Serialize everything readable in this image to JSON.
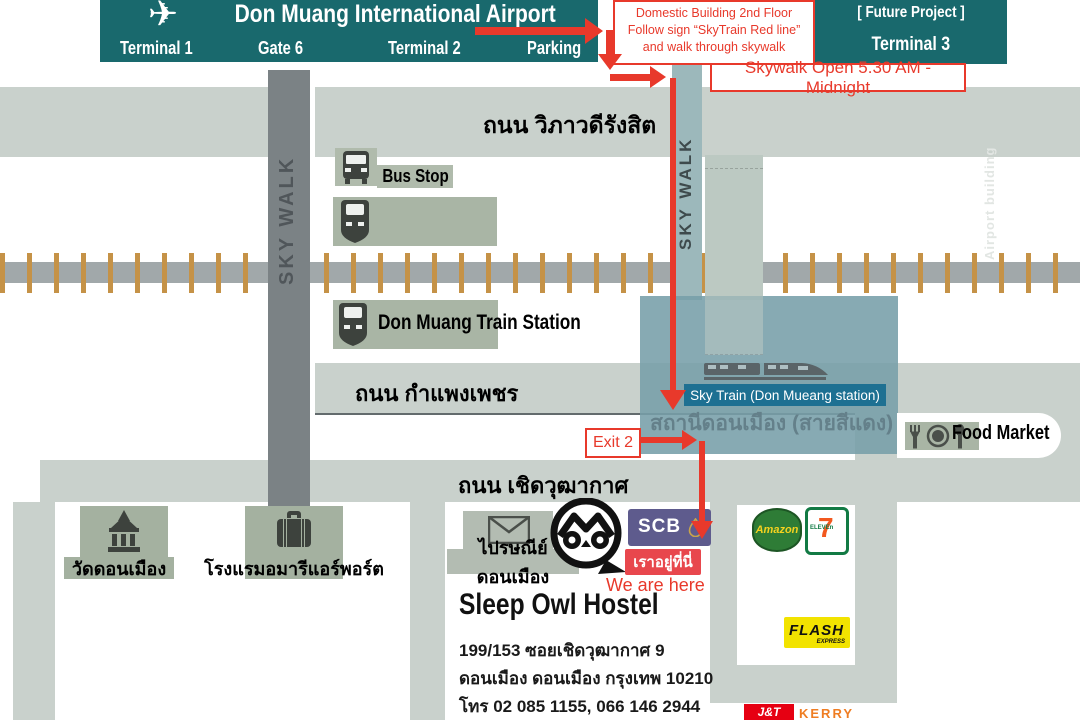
{
  "header": {
    "title": "Don Muang International Airport",
    "terminal1": "Terminal 1",
    "gate6": "Gate 6",
    "terminal2": "Terminal 2",
    "parking": "Parking"
  },
  "future_project": {
    "line1": "[ Future Project ]",
    "line2": "Terminal 3"
  },
  "notes": {
    "domestic1": "Domestic Building 2nd Floor",
    "domestic2": "Follow sign “SkyTrain Red line”",
    "domestic3": "and walk through skywalk",
    "skywalk_hours": "Skywalk Open 5.30 AM - Midnight",
    "exit": "Exit 2",
    "here_th": "เราอยู่ที่นี่",
    "here_en": "We are here"
  },
  "roads": {
    "vibhavadi_rangsit": "ถนน วิภาวดีรังสิต",
    "kamphaeng_phet": "ถนน กำแพงเพชร",
    "choet_wutthakat": "ถนน เชิดวุฒากาศ"
  },
  "skywalk": {
    "label": "SKY WALK"
  },
  "stations": {
    "bus_stop": "Bus Stop",
    "train_station": "Don Muang Train Station",
    "sky_train_en": "Sky Train (Don Mueang station)",
    "sky_train_th": "สถานีดอนเมือง (สายสีแดง)"
  },
  "places": {
    "food_market": "Food Market",
    "temple": "วัดดอนเมือง",
    "hotel": "โรงแรมอมารีแอร์พอร์ต",
    "post_office": "ไปรษณีย์ดอนเมือง",
    "watermark": "Airport building"
  },
  "hostel": {
    "name": "Sleep Owl Hostel",
    "address_line1": "199/153 ซอยเชิดวุฒากาศ 9",
    "address_line2": "ดอนเมือง ดอนเมือง กรุงเทพ 10210",
    "phone": "โทร 02 085 1155, 066 146 2944"
  },
  "brands": {
    "scb": "SCB",
    "amazon": "Amazon",
    "seven": "7",
    "eleven": "ELEVEn",
    "flash": "FLASH",
    "flash_sub": "EXPRESS",
    "jt": "J&T",
    "kerry": "KERRY"
  },
  "colors": {
    "teal": "#19696d",
    "red": "#e8392b",
    "road_gray": "#c9d1cc",
    "station_teal": "#7fa2ab",
    "sky_train_blue": "#1d7092",
    "scb_purple": "#5e5b8d",
    "flash_yellow": "#f2e300",
    "jt_red": "#e60012",
    "kerry_orange": "#ef7d22",
    "tie_brown": "#c59247"
  }
}
